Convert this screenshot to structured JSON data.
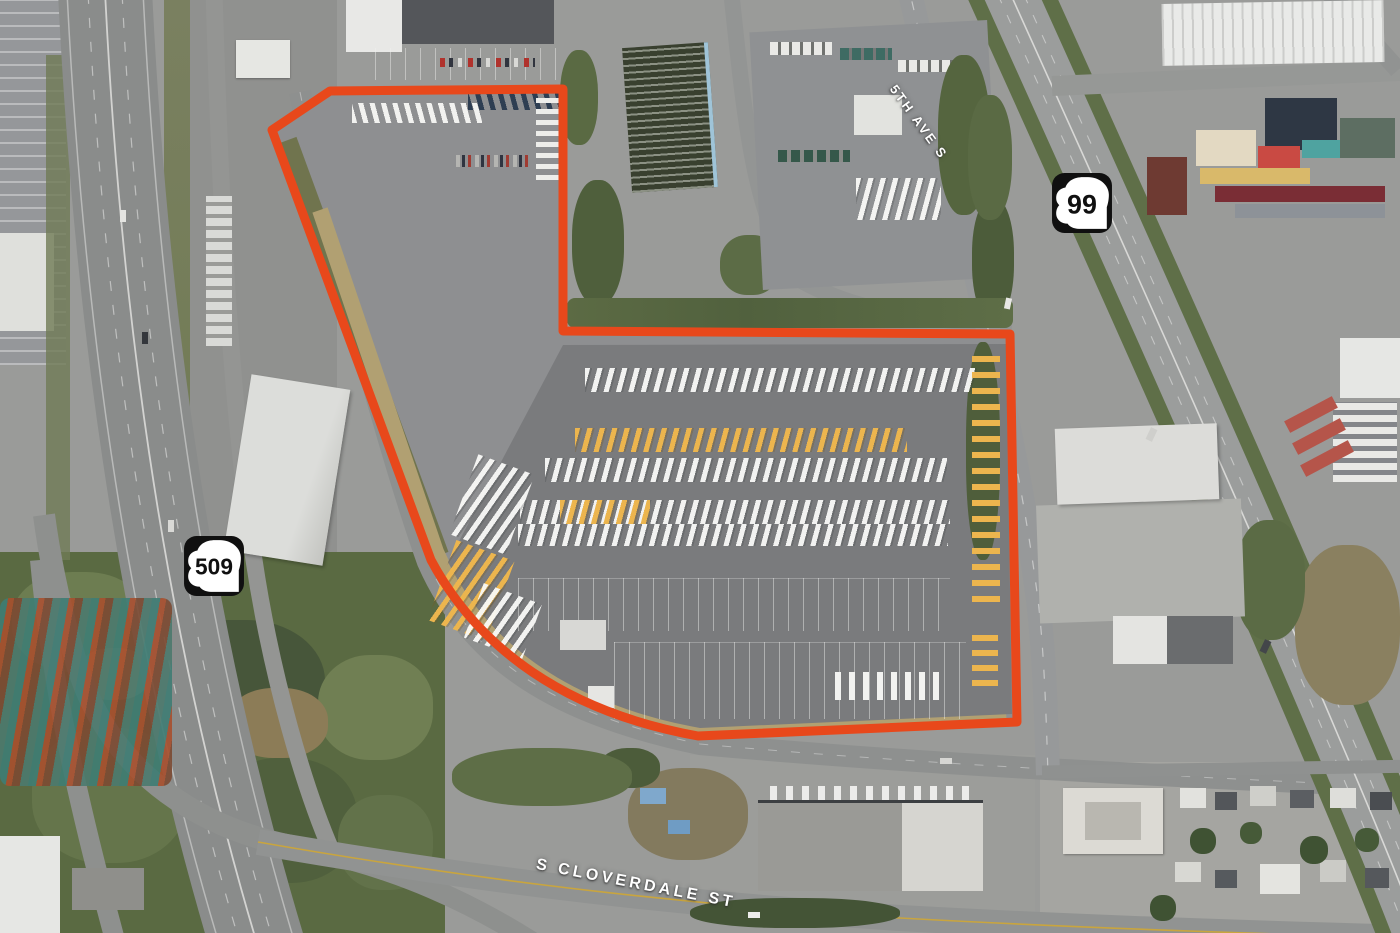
{
  "boundary": {
    "color": "#E8481B"
  },
  "shields": {
    "bg": "#101010",
    "fg": "#ffffff",
    "items": [
      {
        "route": "509"
      },
      {
        "route": "99"
      }
    ]
  },
  "street_labels": {
    "fifth_ave": "5TH AVE S",
    "cloverdale": "S CLOVERDALE ST"
  }
}
